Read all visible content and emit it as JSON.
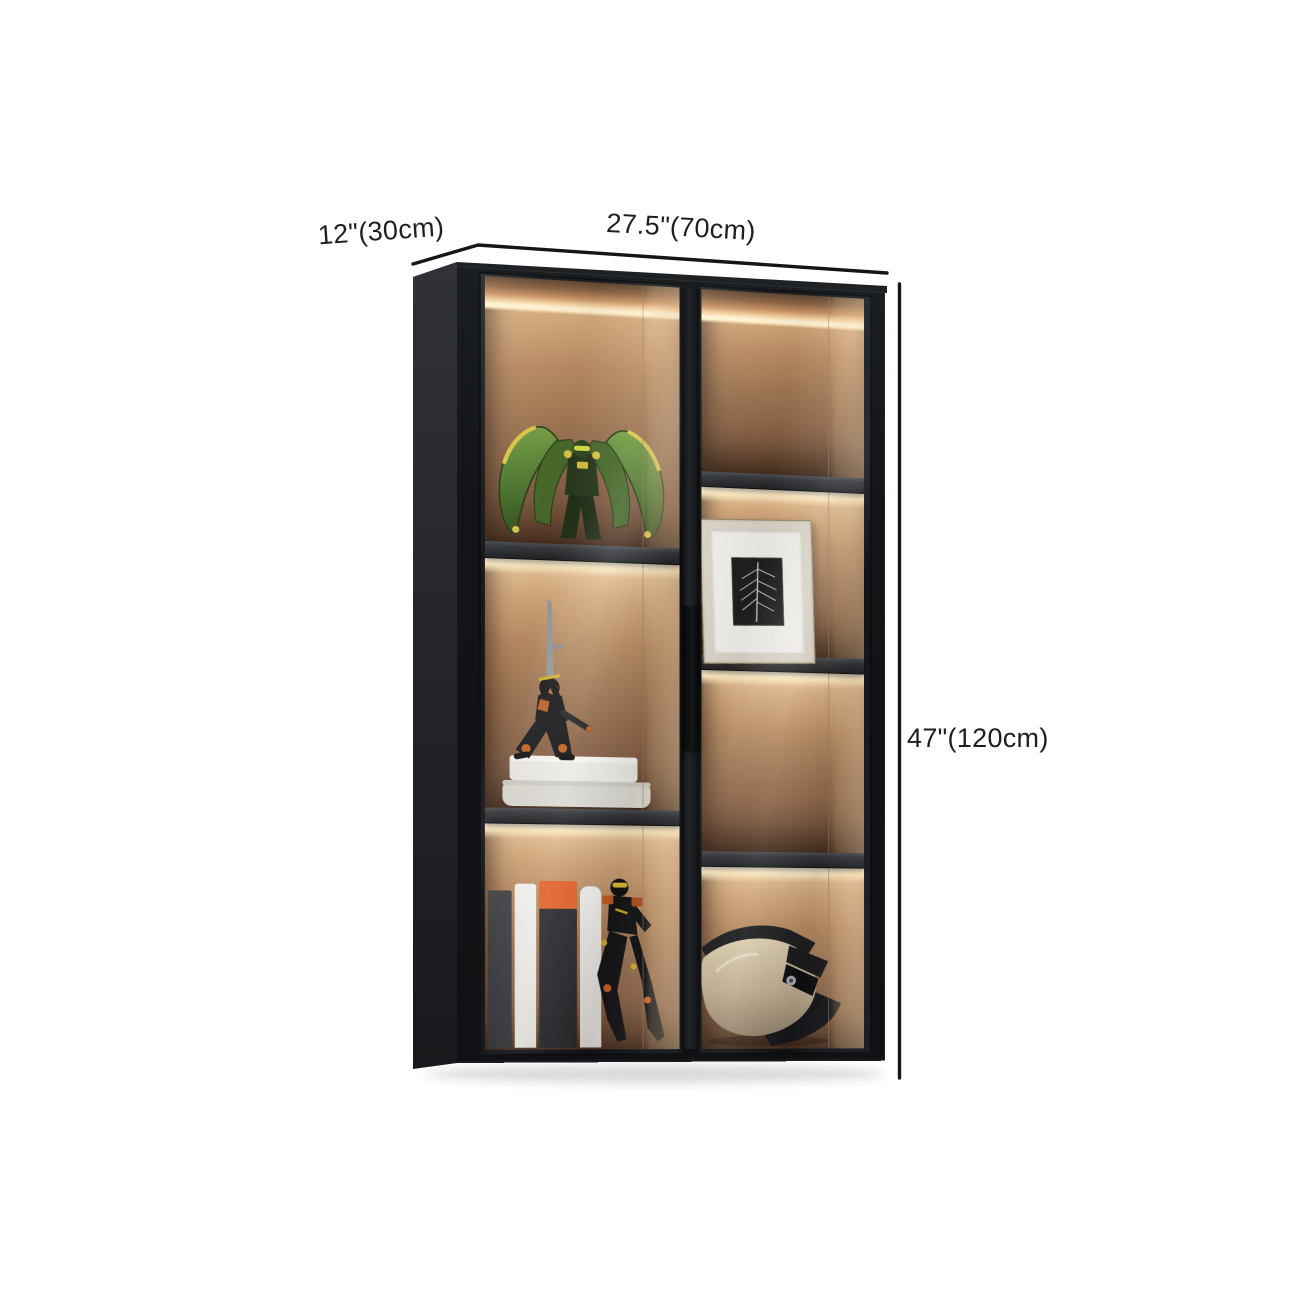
{
  "annotations": {
    "depth_label": "12\"(30cm)",
    "width_label": "27.5\"(70cm)",
    "height_label": "47\"(120cm)"
  },
  "scene": {
    "background_color": "#ffffff",
    "dimension_line_color": "#161616",
    "label_text_color": "#1f1f1f",
    "cabinet": {
      "frame_color": "#15171a",
      "side_panel_color": "#232529",
      "interior_wood_color": "#a97c58",
      "interior_glow_color": "#fff3d6",
      "shelf_color": "#33363a",
      "doors": 2,
      "left_column_compartments": 3,
      "right_column_compartments": 4,
      "contents_left": [
        "green-mecha-figurine",
        "samurai-figurine-on-white-books",
        "vertical-books-and-action-figure"
      ],
      "contents_right": [
        "empty-lit-compartment",
        "framed-leaf-artwork",
        "empty-lit-compartment",
        "motocross-helmet"
      ]
    }
  }
}
